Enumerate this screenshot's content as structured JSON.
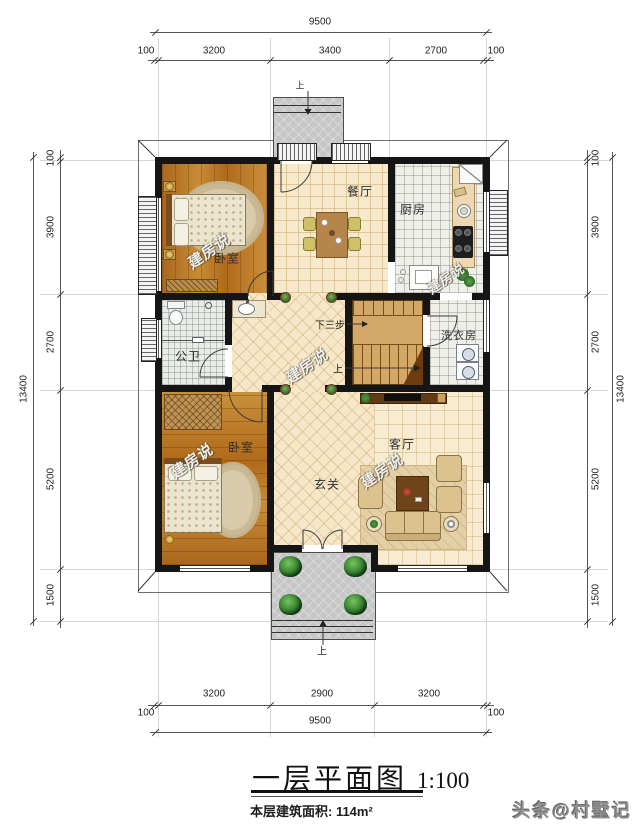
{
  "title": {
    "main": "一层平面图",
    "scale": "1:100",
    "area": "本层建筑面积: 114m²"
  },
  "footer": {
    "brand": "头条@村墅记"
  },
  "watermark": {
    "text": "建房说"
  },
  "rooms": {
    "bedroom_top": "卧室",
    "dining": "餐厅",
    "kitchen": "厨房",
    "bathroom": "公卫",
    "laundry": "洗衣房",
    "bedroom_bottom": "卧室",
    "foyer": "玄关",
    "living": "客厅"
  },
  "stairs": {
    "down": "下三步",
    "up": "上"
  },
  "porch": {
    "top_mark": "上",
    "bottom_mark": "上"
  },
  "dimensions": {
    "top": {
      "overall": "9500",
      "segs": [
        "100",
        "3200",
        "3400",
        "2700",
        "100"
      ]
    },
    "bottom": {
      "overall": "9500",
      "segs": [
        "3200",
        "2900",
        "3200"
      ],
      "end_left": "100",
      "end_right": "100"
    },
    "left": {
      "overall": "13400",
      "segs": [
        "100",
        "3900",
        "2700",
        "5200",
        "1500"
      ]
    },
    "right": {
      "overall": "13400",
      "segs": [
        "100",
        "3900",
        "2700",
        "5200",
        "1500"
      ]
    }
  }
}
